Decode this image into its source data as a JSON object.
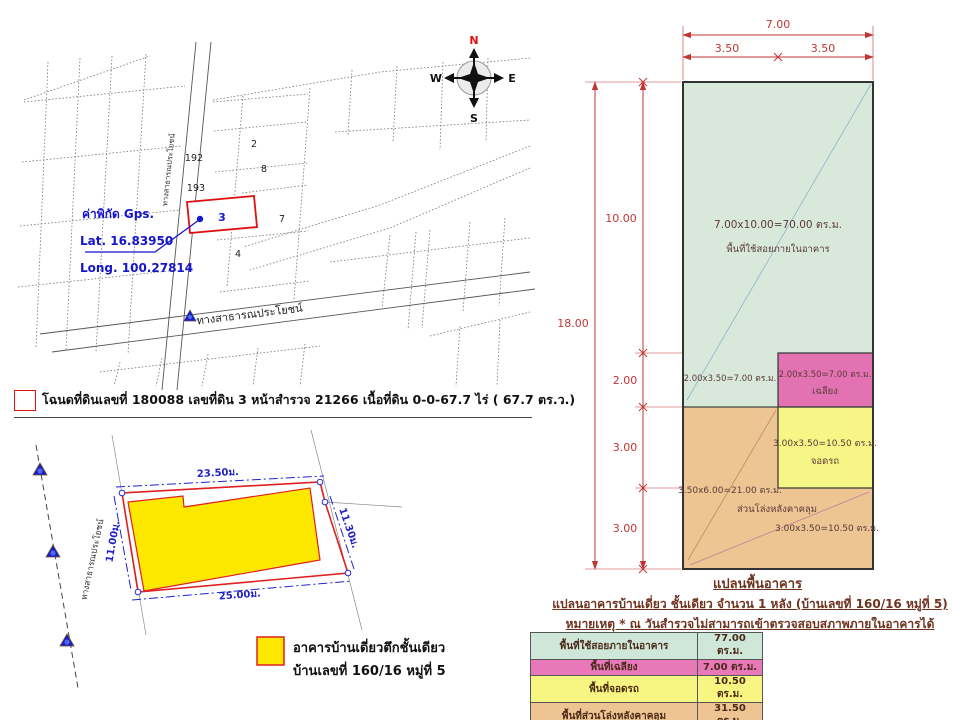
{
  "map": {
    "compass": {
      "n": "N",
      "e": "E",
      "s": "S",
      "w": "W"
    },
    "gps": {
      "title": "ค่าพิกัด Gps.",
      "lat": "Lat.  16.83950",
      "long": "Long. 100.27814"
    },
    "road_vertical_label": "ทางสาธารณประโยชน์",
    "road_bottom_label": "ทางสาธารณประโยชน์",
    "plots": [
      {
        "label": "2"
      },
      {
        "label": "192"
      },
      {
        "label": "8"
      },
      {
        "label": "193"
      },
      {
        "label": "3"
      },
      {
        "label": "7"
      },
      {
        "label": "4"
      }
    ],
    "deed_line": "โฉนดที่ดินเลขที่ 180088  เลขที่ดิน 3 หน้าสำรวจ 21266 เนื้อที่ดิน 0-0-67.7 ไร่ ( 67.7 ตร.ว.)"
  },
  "site_plan": {
    "road_label": "ทางสาธารณประโยชน์",
    "dims": {
      "top": "23.50ม.",
      "bottom": "25.00ม.",
      "left": "11.00ม.",
      "right": "11.30ม."
    },
    "legend": {
      "line1": "อาคารบ้านเดี่ยวตึกชั้นเดียว",
      "line2": "บ้านเลขที่ 160/16 หมู่ที่ 5"
    }
  },
  "floor_plan": {
    "dims": {
      "total_width": "7.00",
      "half_left": "3.50",
      "half_right": "3.50",
      "total_height": "18.00",
      "seg_10": "10.00",
      "seg_2": "2.00",
      "seg_3a": "3.00",
      "seg_3b": "3.00"
    },
    "areas": {
      "main_calc": "7.00x10.00=70.00 ตร.ม.",
      "main_name": "พื้นที่ใช้สอยภายในอาคาร",
      "green_ext_calc": "2.00x3.50=7.00 ตร.ม.",
      "porch_calc": "2.00x3.50=7.00 ตร.ม.",
      "porch_name": "เฉลียง",
      "parking_calc": "3.00x3.50=10.50 ตร.ม.",
      "parking_name": "จอดรถ",
      "open_calc": "3.50x6.00=21.00 ตร.ม.",
      "open_name": "ส่วนโล่งหลังคาคลุม",
      "open_calc2": "3.00x3.50=10.50 ตร.ม."
    },
    "caption": "แปลนพื้นอาคาร",
    "note1": "แปลนอาคารบ้านเดี่ยว ชั้นเดียว จำนวน 1 หลัง (บ้านเลขที่ 160/16 หมู่ที่ 5)",
    "note2": "หมายเหตุ * ณ วันสำรวจไม่สามารถเข้าตรวจสอบสภาพภายในอาคารได้"
  },
  "area_table": {
    "rows": [
      {
        "label": "พื้นที่ใช้สอยภายในอาคาร",
        "value": "77.00 ตร.ม.",
        "color": "#cfe7d9"
      },
      {
        "label": "พื้นที่เฉลียง",
        "value": "7.00 ตร.ม.",
        "color": "#e878b8"
      },
      {
        "label": "พื้นที่จอดรถ",
        "value": "10.50 ตร.ม.",
        "color": "#f8f682"
      },
      {
        "label": "พื้นที่ส่วนโล่งหลังคาคลุม",
        "value": "31.50 ตร.ม.",
        "color": "#eec493"
      }
    ]
  },
  "colors": {
    "parcel_highlight": "#e01010",
    "gps_blue": "#1515cc",
    "building_yellow": "#ffe800",
    "plan_green": "#d8e9dc",
    "plan_pink": "#e372b2",
    "plan_yellow": "#f6f687",
    "plan_orange": "#ecc593",
    "dimension_red": "#c23535",
    "note_maroon": "#6e3420"
  }
}
